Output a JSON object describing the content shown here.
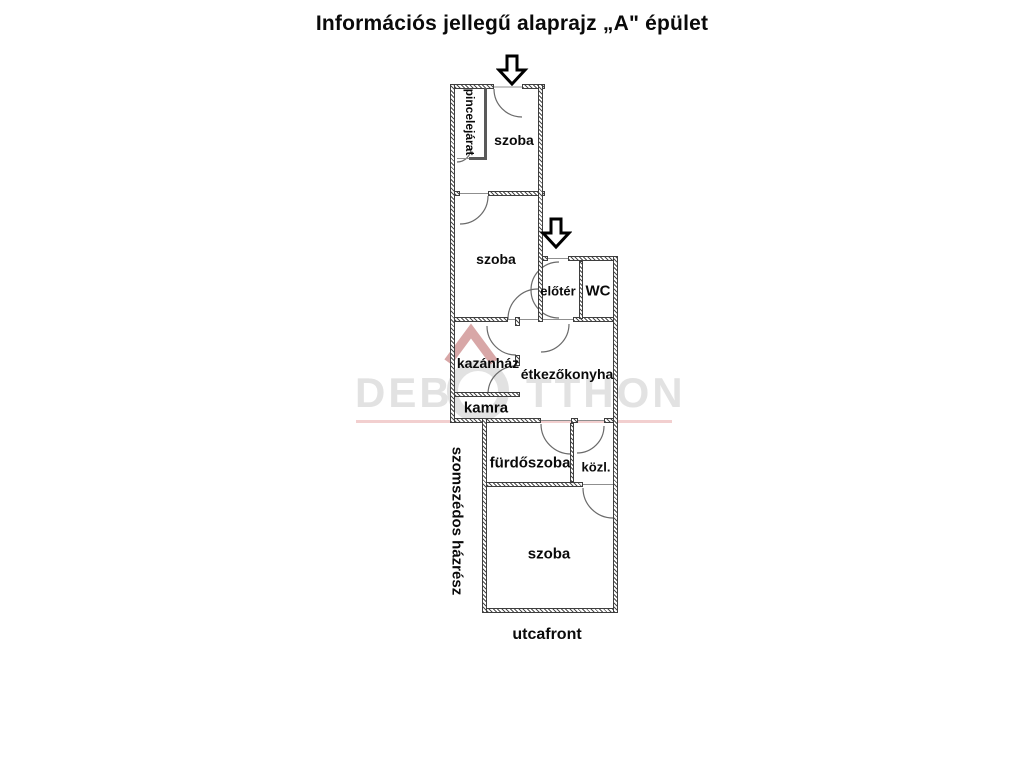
{
  "title": "Információs jellegű alaprajz „A\" épület",
  "rooms": {
    "szoba_top": {
      "label": "szoba"
    },
    "pincelejarat": {
      "label": "pincelejárat"
    },
    "szoba_middle": {
      "label": "szoba"
    },
    "eloter": {
      "label": "előtér"
    },
    "wc": {
      "label": "WC"
    },
    "kazanhaz": {
      "label": "kazánház"
    },
    "etkezokonyha": {
      "label": "étkezőkonyha"
    },
    "kamra": {
      "label": "kamra"
    },
    "furdoszoba": {
      "label": "fürdőszoba"
    },
    "kozlekedo": {
      "label": "közl."
    },
    "szoba_bottom": {
      "label": "szoba"
    }
  },
  "annotations": {
    "street_front": "utcafront",
    "neighboring_house": "szomszédos házrész"
  },
  "watermark": {
    "text_left": "DEB",
    "text_right": "TTHON",
    "letter_color": "#e2e2e2",
    "underline_color": "#f2cfcf",
    "roof_color": "#d8a7a7"
  },
  "colors": {
    "wall": "#3e3e3e",
    "label": "#0a0a0a",
    "arrow_outline": "#000000"
  }
}
